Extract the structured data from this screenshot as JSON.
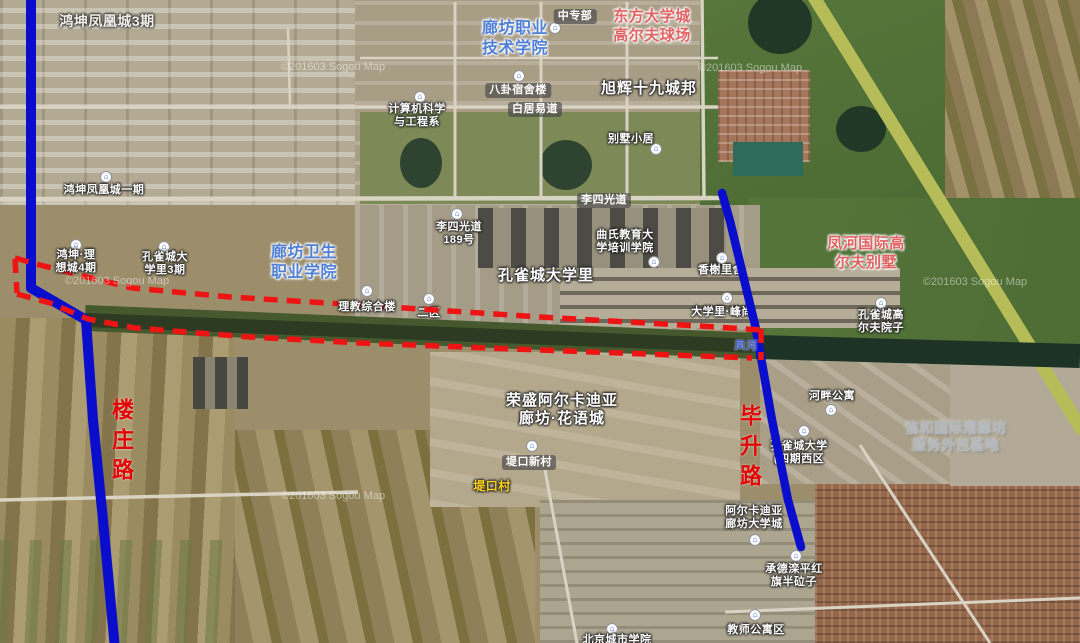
{
  "map": {
    "watermark_text": "©201603 Sogou Map",
    "road_names": {
      "left_vertical": "楼庄路",
      "right_vertical": "毕升路"
    },
    "colors": {
      "route_blue": "#0a0ecc",
      "planned_route_red": "#ee1414",
      "road_name_red": "#e30505",
      "campus_label_blue": "#4f80d6",
      "resort_label_pink": "#e06262",
      "gray_label": "#b2b8be",
      "village_label_yellow": "#ffd21e",
      "river_label_blue": "#3f5fd8"
    }
  },
  "icons": {
    "poi_glyph": "⌂"
  },
  "labels": {
    "hongkun_phoenix_3": "鸿坤凤凰城3期",
    "hongkun_phoenix_1": "鸿坤凤凰城一期",
    "langfang_polytechnic": "廊坊职业\n技术学院",
    "zhongzhuanbu": "中专部",
    "dongfang_golf": "东方大学城\n高尔夫球场",
    "xuhui_19": "旭辉十九城邦",
    "bagua_dorm": "八卦宿舍楼",
    "computer_dept": "计算机科学\n与工程系",
    "baijuyi_road": "白居易道",
    "bieshu_xiaoju": "别墅小居",
    "lisiguang_road": "李四光道",
    "lisiguang_189": "李四光道\n189号",
    "qushi_education": "曲氏教育大\n学培训学院",
    "kongquecheng_daxueli": "孔雀城大学里",
    "xiangxie_lishe": "香榭里舍",
    "fenghe_intl_villa": "凤河国际高\n尔夫别墅",
    "hongkun_lixiang_4": "鸿坤·理\n想城4期",
    "kongquecheng_3": "孔雀城大\n学里3期",
    "langfang_health": "廊坊卫生\n职业学院",
    "lijiao_building": "理教综合楼",
    "er_qu": "二区",
    "daxueli_feng": "大学里·峰尚",
    "kongquecheng_golf": "孔雀城高\n尔夫院子",
    "fenghe_river": "凤河",
    "hepan_apartment": "河畔公寓",
    "rongsheng_arcadia": "荣盛阿尔卡迪亚\n廊坊·花语城",
    "xinhe_outsourcing": "信和国际港廊坊\n服务外包基地",
    "dikou_xincun": "堤口新村",
    "dikou_village": "堤口村",
    "kongquecheng_4_west": "孔雀城大学\n(四期西区",
    "arcadia_university": "阿尔卡迪亚\n廊坊大学城",
    "chengde_luanping": "承德滦平红\n旗半砬子",
    "teacher_apartment": "教师公寓区",
    "beijing_city_univ": "北京城市学院"
  }
}
